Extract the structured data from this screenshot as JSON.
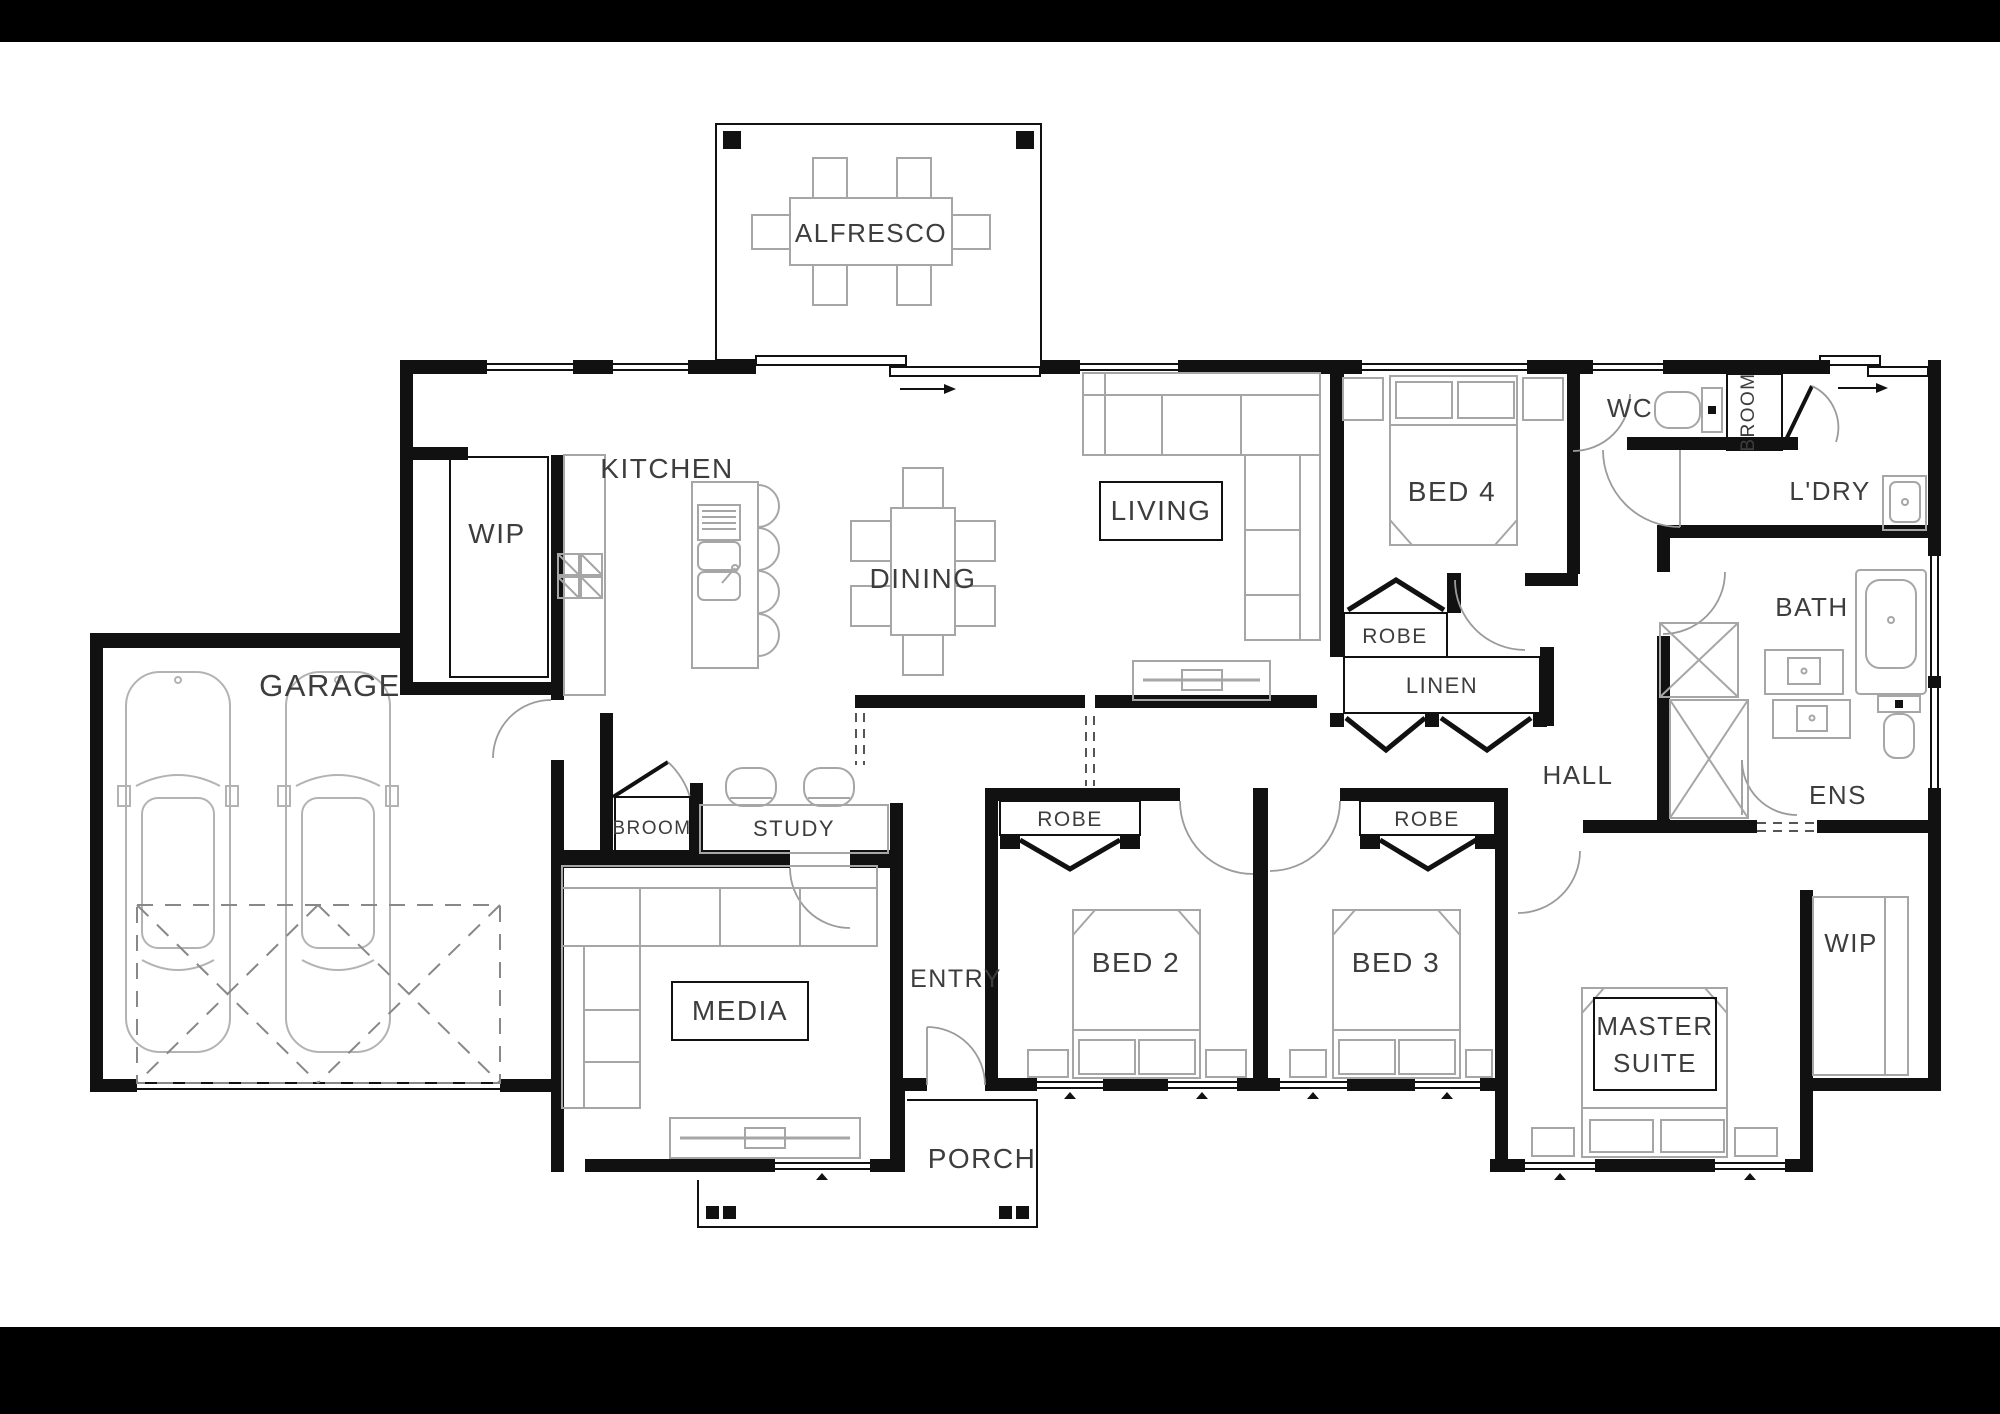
{
  "plan": {
    "rooms": {
      "alfresco": {
        "label": "ALFRESCO"
      },
      "pantry": {
        "label": "WIP"
      },
      "kitchen": {
        "label": "KITCHEN"
      },
      "dining": {
        "label": "DINING"
      },
      "living": {
        "label": "LIVING"
      },
      "bed4": {
        "label": "BED 4"
      },
      "wc": {
        "label": "WC"
      },
      "broom_cupboard": {
        "label": "BROOM"
      },
      "laundry": {
        "label": "L'DRY"
      },
      "bath": {
        "label": "BATH"
      },
      "robe_bed4": {
        "label": "ROBE"
      },
      "linen": {
        "label": "LINEN"
      },
      "hall": {
        "label": "HALL"
      },
      "ensuite": {
        "label": "ENS"
      },
      "garage": {
        "label": "GARAGE"
      },
      "broom_study": {
        "label": "BROOM"
      },
      "study": {
        "label": "STUDY"
      },
      "media": {
        "label": "MEDIA"
      },
      "entry": {
        "label": "ENTRY"
      },
      "robe_bed2": {
        "label": "ROBE"
      },
      "robe_bed3": {
        "label": "ROBE"
      },
      "bed2": {
        "label": "BED 2"
      },
      "bed3": {
        "label": "BED 3"
      },
      "master_suite": {
        "label_line1": "MASTER",
        "label_line2": "SUITE"
      },
      "wip_master": {
        "label": "WIP"
      },
      "porch": {
        "label": "PORCH"
      }
    },
    "colors": {
      "wall": "#111111",
      "furniture_outline": "#a6a6a6",
      "label_text": "#3d3d3d",
      "background": "#ffffff",
      "letterbox": "#000000"
    }
  }
}
